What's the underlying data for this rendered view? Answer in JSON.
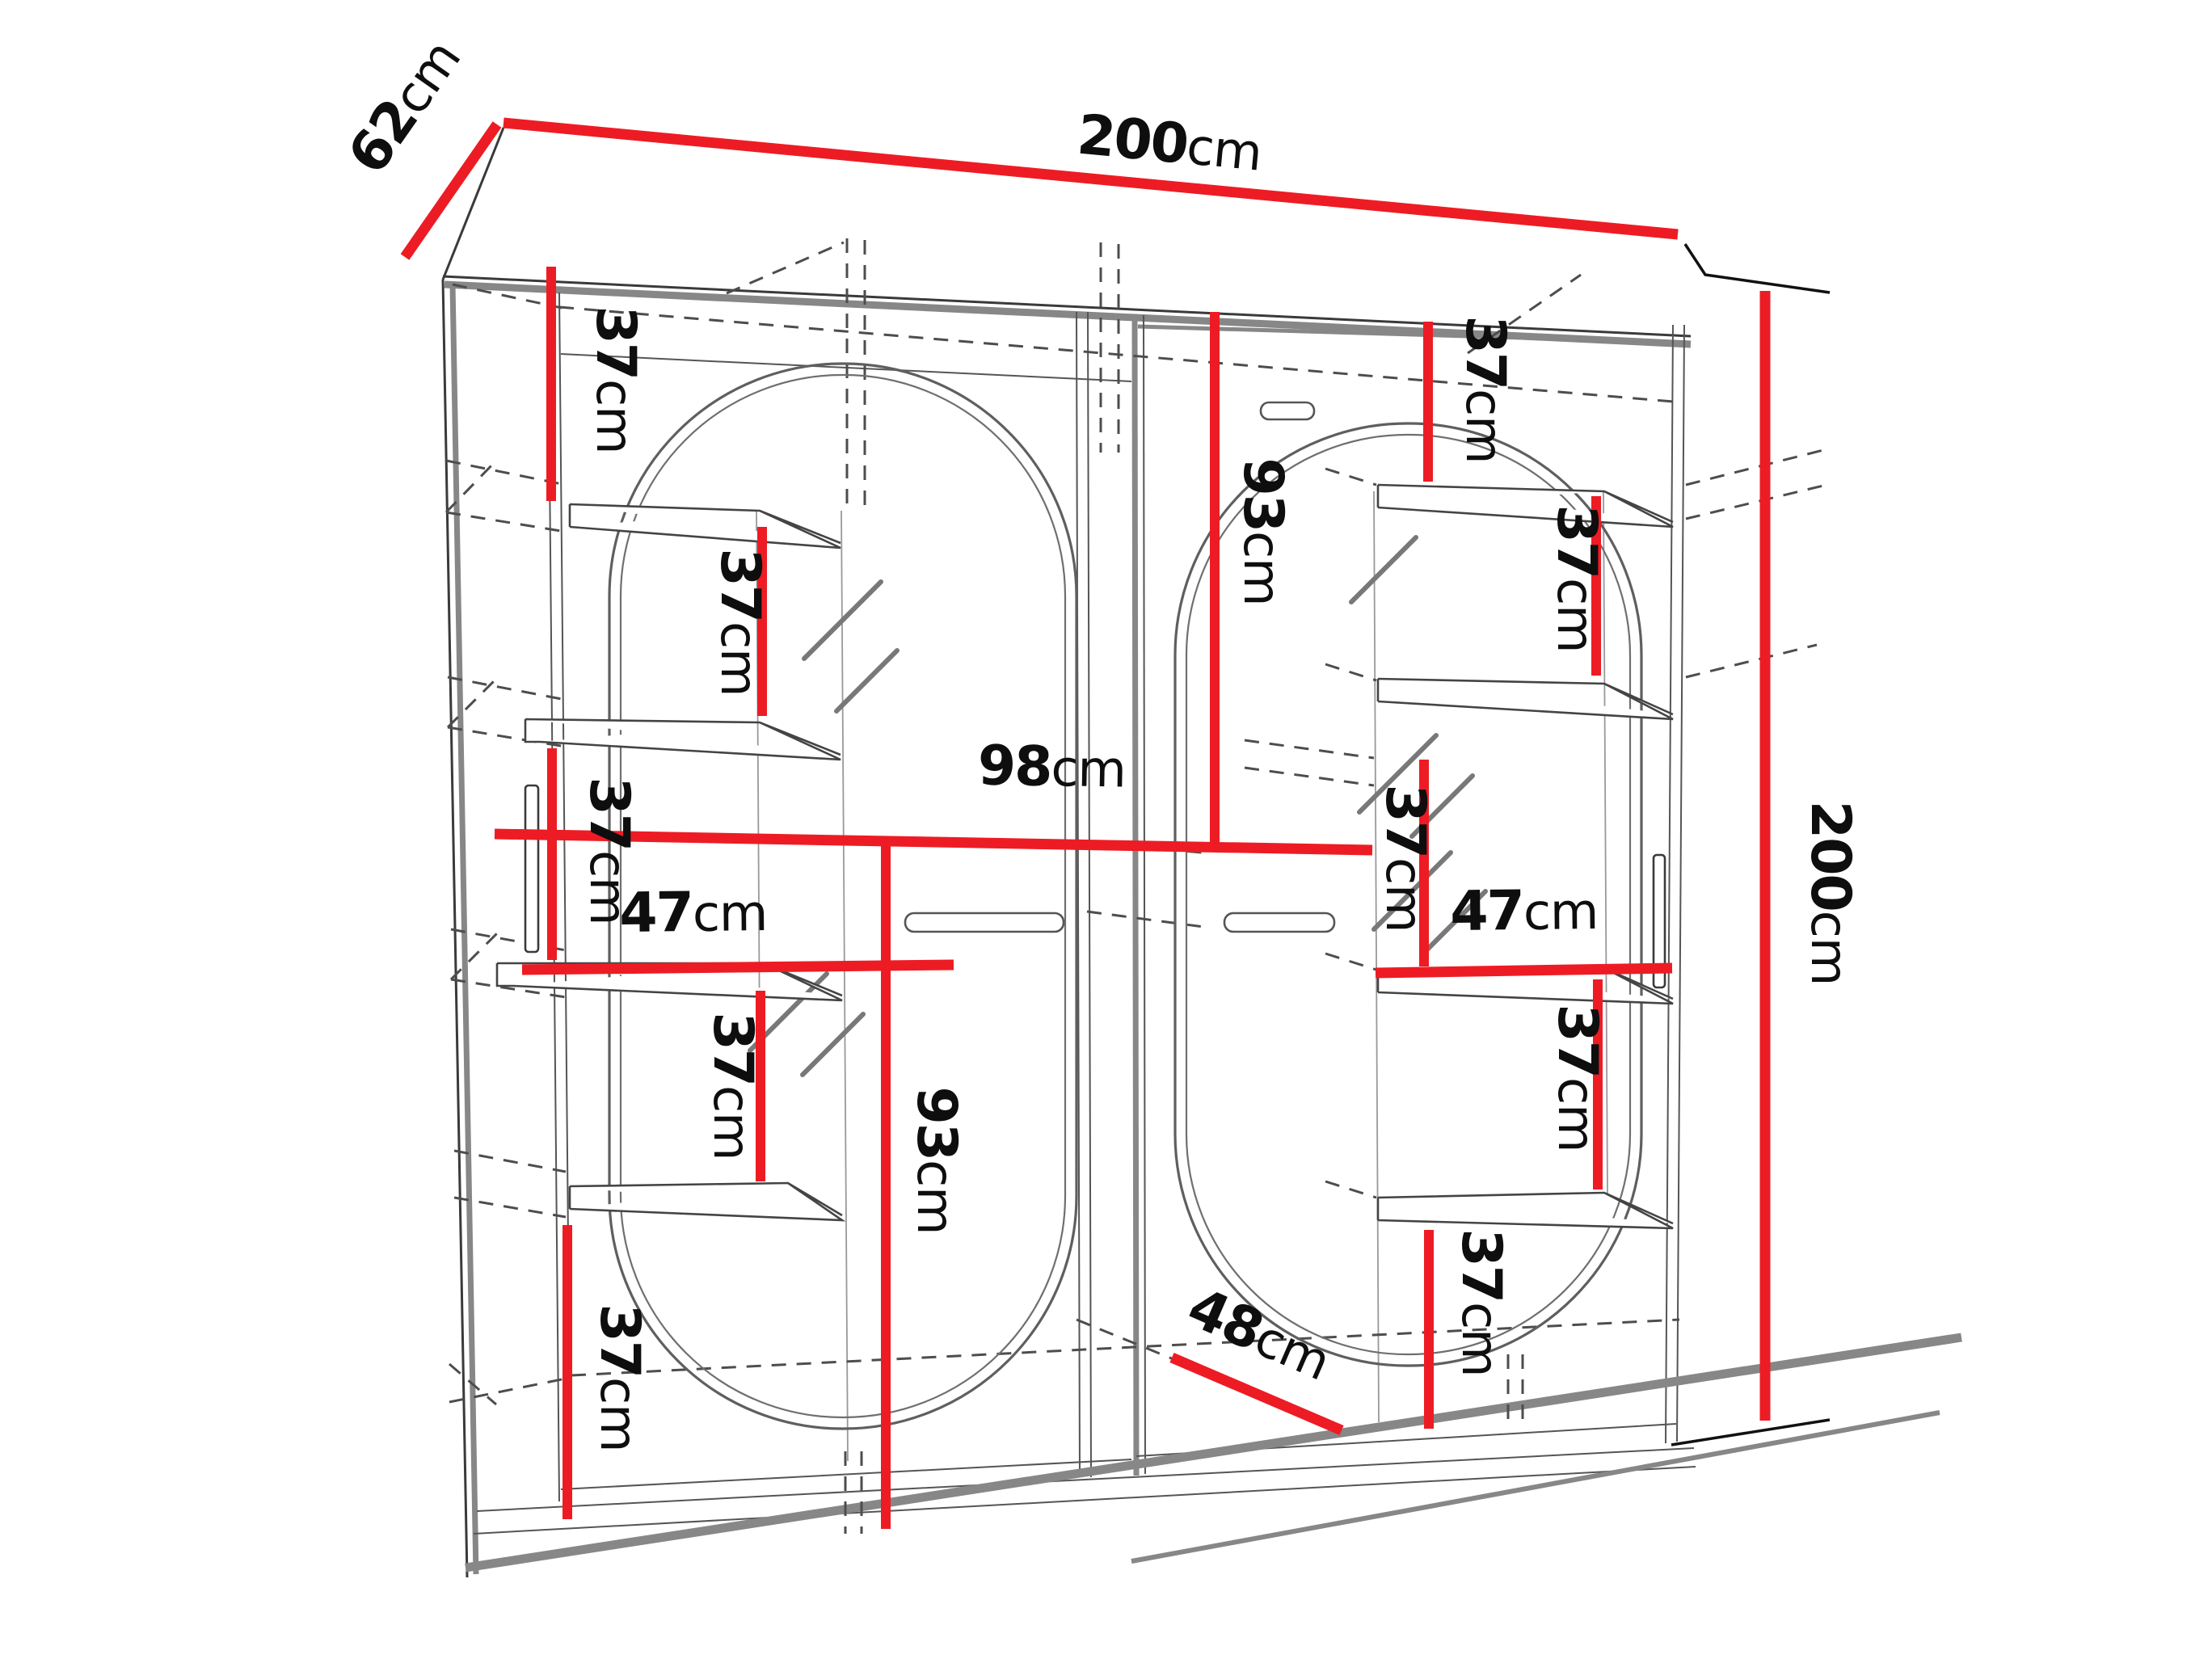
{
  "diagram": {
    "type": "furniture-dimension-diagram",
    "subject": "two-door sliding wardrobe with oval mirrors and interior shelves",
    "colors": {
      "dimension_line": "#ed1c24",
      "outline": "#3a3a3a",
      "hidden_edge": "#4d4d4d",
      "shadow": "#878787",
      "background": "#ffffff"
    },
    "overall": {
      "width": "200cm",
      "height": "200cm",
      "depth": "62cm"
    }
  },
  "labels": [
    {
      "id": "depth-top-left",
      "value": "62",
      "unit": "cm"
    },
    {
      "id": "width-top",
      "value": "200",
      "unit": "cm"
    },
    {
      "id": "height-right",
      "value": "200",
      "unit": "cm"
    },
    {
      "id": "left-shelf-gap-1",
      "value": "37",
      "unit": "cm"
    },
    {
      "id": "left-shelf-gap-2",
      "value": "37",
      "unit": "cm"
    },
    {
      "id": "left-shelf-gap-3",
      "value": "37",
      "unit": "cm"
    },
    {
      "id": "left-shelf-width",
      "value": "47",
      "unit": "cm"
    },
    {
      "id": "left-shelf-gap-4",
      "value": "37",
      "unit": "cm"
    },
    {
      "id": "left-shelf-gap-5",
      "value": "37",
      "unit": "cm"
    },
    {
      "id": "interior-section-width",
      "value": "98",
      "unit": "cm"
    },
    {
      "id": "hanging-height-left",
      "value": "93",
      "unit": "cm"
    },
    {
      "id": "hanging-height-right",
      "value": "93",
      "unit": "cm"
    },
    {
      "id": "right-shelf-gap-1",
      "value": "37",
      "unit": "cm"
    },
    {
      "id": "right-shelf-gap-2",
      "value": "37",
      "unit": "cm"
    },
    {
      "id": "right-shelf-gap-3",
      "value": "37",
      "unit": "cm"
    },
    {
      "id": "right-shelf-width",
      "value": "47",
      "unit": "cm"
    },
    {
      "id": "right-shelf-gap-4",
      "value": "37",
      "unit": "cm"
    },
    {
      "id": "right-shelf-gap-5",
      "value": "37",
      "unit": "cm"
    },
    {
      "id": "floor-depth",
      "value": "48",
      "unit": "cm"
    }
  ]
}
